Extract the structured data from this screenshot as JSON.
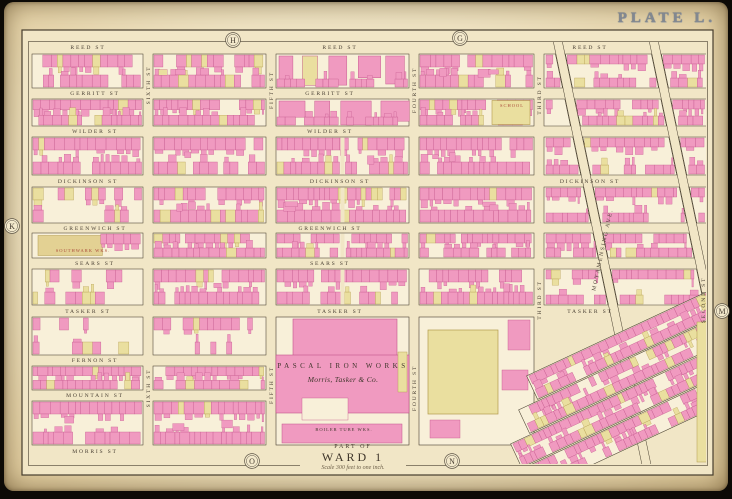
{
  "plate": {
    "title": "PLATE L.",
    "part_of": "PART OF",
    "ward": "WARD 1",
    "scale_note": "Scale 300 feet to one inch."
  },
  "edge_letters": [
    {
      "letter": "H",
      "x": 233,
      "y": 40
    },
    {
      "letter": "G",
      "x": 460,
      "y": 38
    },
    {
      "letter": "K",
      "x": 12,
      "y": 226
    },
    {
      "letter": "M",
      "x": 722,
      "y": 311
    },
    {
      "letter": "O",
      "x": 252,
      "y": 461
    },
    {
      "letter": "N",
      "x": 452,
      "y": 461
    }
  ],
  "colors": {
    "map_bg": "#f1e6c6",
    "block_fill": "#f8f0d9",
    "line": "#463d2d",
    "pink": "#f09ac0",
    "pink_stroke": "#c2558b",
    "yellow": "#eadf9f",
    "yellow_stroke": "#b29a4c",
    "tan": "#e3d193",
    "street_text": "#4a4034",
    "red_label": "#a9483a"
  },
  "map": {
    "frame": {
      "outer": [
        22,
        30,
        691,
        445
      ],
      "inner": [
        28,
        41,
        679,
        424
      ]
    },
    "streets": {
      "horizontal": [
        {
          "name": "REED ST",
          "y": 47,
          "xs": [
            88,
            340,
            590
          ]
        },
        {
          "name": "GERRITT ST",
          "y": 93,
          "xs": [
            95,
            330
          ]
        },
        {
          "name": "WILDER ST",
          "y": 131,
          "xs": [
            95,
            330
          ]
        },
        {
          "name": "DICKINSON ST",
          "y": 181,
          "xs": [
            88,
            340,
            590
          ]
        },
        {
          "name": "GREENWICH ST",
          "y": 228,
          "xs": [
            95,
            330
          ]
        },
        {
          "name": "SEARS ST",
          "y": 263,
          "xs": [
            95,
            330
          ]
        },
        {
          "name": "TASKER ST",
          "y": 311,
          "xs": [
            88,
            340,
            590
          ]
        },
        {
          "name": "FERNON ST",
          "y": 360,
          "xs": [
            95
          ]
        },
        {
          "name": "MOUNTAIN ST",
          "y": 395,
          "xs": [
            95
          ]
        },
        {
          "name": "MORRIS ST",
          "y": 451,
          "xs": [
            95,
            340
          ]
        }
      ],
      "vertical": [
        {
          "name": "SIXTH ST",
          "x": 148,
          "ys": [
            85,
            388
          ]
        },
        {
          "name": "FIFTH ST",
          "x": 271,
          "ys": [
            90,
            385
          ]
        },
        {
          "name": "FOURTH ST",
          "x": 414,
          "ys": [
            90,
            388
          ]
        },
        {
          "name": "THIRD ST",
          "x": 539,
          "ys": [
            95,
            300
          ]
        },
        {
          "name": "SECOND ST",
          "x": 703,
          "ys": [
            300
          ]
        }
      ],
      "diagonal": [
        {
          "name": "MOYAMENSING AVE.",
          "x1": 556,
          "y1": 33,
          "x2": 648,
          "y2": 472,
          "label_at": [
            604,
            250
          ]
        },
        {
          "name": "",
          "x1": 652,
          "y1": 33,
          "x2": 744,
          "y2": 472,
          "label_at": null
        }
      ]
    },
    "grid": {
      "cols": [
        [
          32,
          143
        ],
        [
          153,
          266
        ],
        [
          276,
          409
        ],
        [
          419,
          534
        ]
      ],
      "rows": [
        [
          54,
          88
        ],
        [
          99,
          126
        ],
        [
          137,
          175
        ],
        [
          187,
          223
        ],
        [
          233,
          258
        ],
        [
          269,
          305
        ],
        [
          317,
          355
        ],
        [
          366,
          390
        ],
        [
          401,
          445
        ]
      ],
      "styles": {
        "0,3": "sparse",
        "0,4": "tan",
        "0,5": "sparse",
        "0,6": "sparse",
        "2,0": "factory",
        "2,1": "factory",
        "3,1": "school",
        "1,6": "sparse"
      },
      "merged": [
        "2,7",
        "2,8",
        "3,7",
        "3,8"
      ],
      "specials": {
        "2,6": "ironworks",
        "3,6": "soapworks"
      }
    },
    "landmarks": [
      {
        "text": "PASCAL IRON WORKS",
        "x": 343,
        "y": 368,
        "size": 7,
        "spacing": 3.5,
        "style": "caps"
      },
      {
        "text": "Morris, Tasker & Co.",
        "x": 343,
        "y": 382,
        "size": 7.5,
        "style": "script"
      },
      {
        "text": "BOILER TUBE WKS.",
        "x": 344,
        "y": 431,
        "size": 4.5,
        "style": "caps-small"
      },
      {
        "text": "SOUTHWARK WKS.",
        "x": 83,
        "y": 252,
        "size": 4.5,
        "style": "red"
      },
      {
        "text": "SCHOOL",
        "x": 512,
        "y": 107,
        "size": 4.5,
        "style": "red"
      }
    ]
  }
}
